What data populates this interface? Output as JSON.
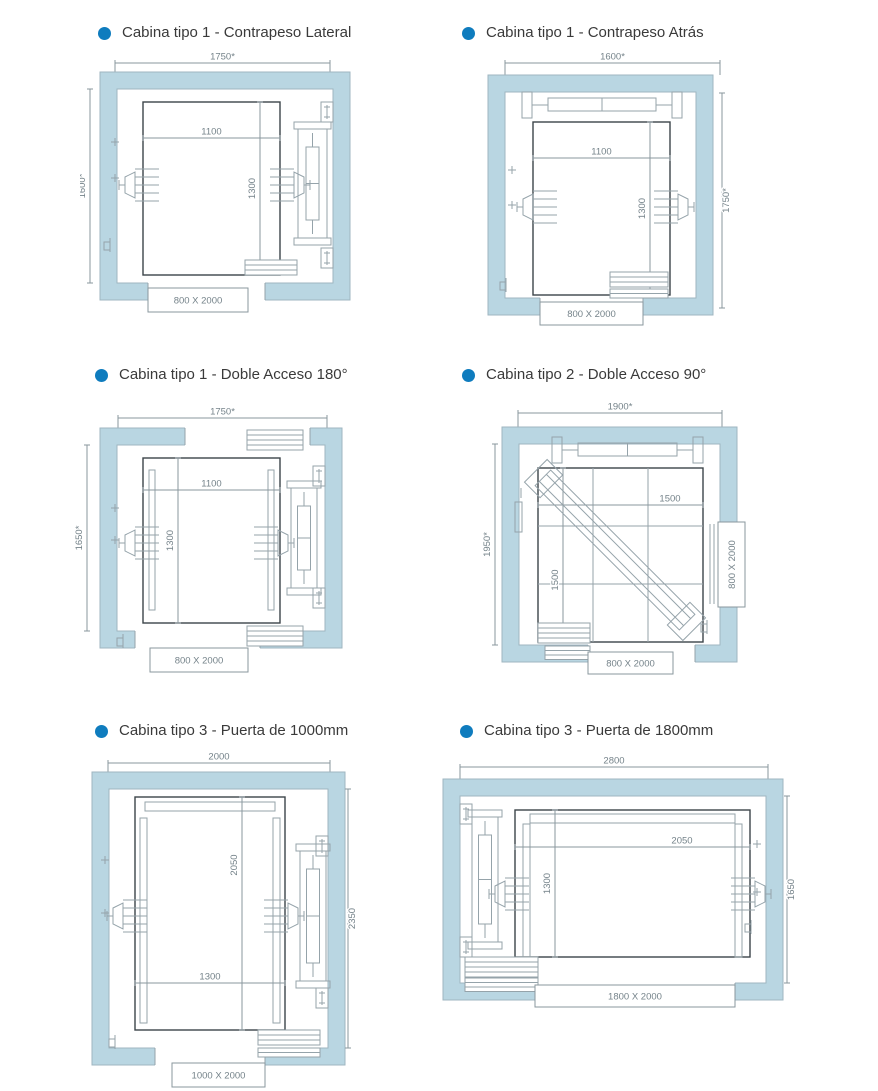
{
  "palette": {
    "wall": "#b9d6e2",
    "wall_stroke": "#9fb6c0",
    "line": "#95a3aa",
    "dimline": "#8a979e",
    "dark": "#3c4449",
    "dim_text": "#75838a",
    "title_text": "#3a3a3a",
    "bullet": "#0f7cbe"
  },
  "diagrams": [
    {
      "id": "d1",
      "title": "Cabina tipo 1 - Contrapeso Lateral",
      "dims": {
        "top": "1750*",
        "side": "1600*",
        "width": "1100",
        "depth": "1300",
        "door": "800 X 2000"
      }
    },
    {
      "id": "d2",
      "title": "Cabina tipo 1 - Contrapeso Atrás",
      "dims": {
        "top": "1600*",
        "side": "1750*",
        "width": "1100",
        "depth": "1300",
        "door": "800 X 2000"
      }
    },
    {
      "id": "d3",
      "title": "Cabina tipo 1 - Doble Acceso 180°",
      "dims": {
        "top": "1750*",
        "side": "1650*",
        "width": "1100",
        "depth": "1300",
        "door": "800 X 2000"
      }
    },
    {
      "id": "d4",
      "title": "Cabina tipo 2 - Doble Acceso 90°",
      "dims": {
        "top": "1900*",
        "side": "1950*",
        "width": "1500",
        "depth": "1500",
        "door": "800 X 2000",
        "door_side": "800 X 2000"
      }
    },
    {
      "id": "d5",
      "title": "Cabina tipo 3 - Puerta de 1000mm",
      "dims": {
        "top": "2000",
        "side": "2350",
        "width": "1300",
        "depth": "2050",
        "door": "1000 X 2000"
      }
    },
    {
      "id": "d6",
      "title": "Cabina tipo 3 - Puerta de 1800mm",
      "dims": {
        "top": "2800",
        "side": "1650",
        "width": "2050",
        "depth": "1300",
        "door": "1800 X 2000"
      }
    }
  ]
}
